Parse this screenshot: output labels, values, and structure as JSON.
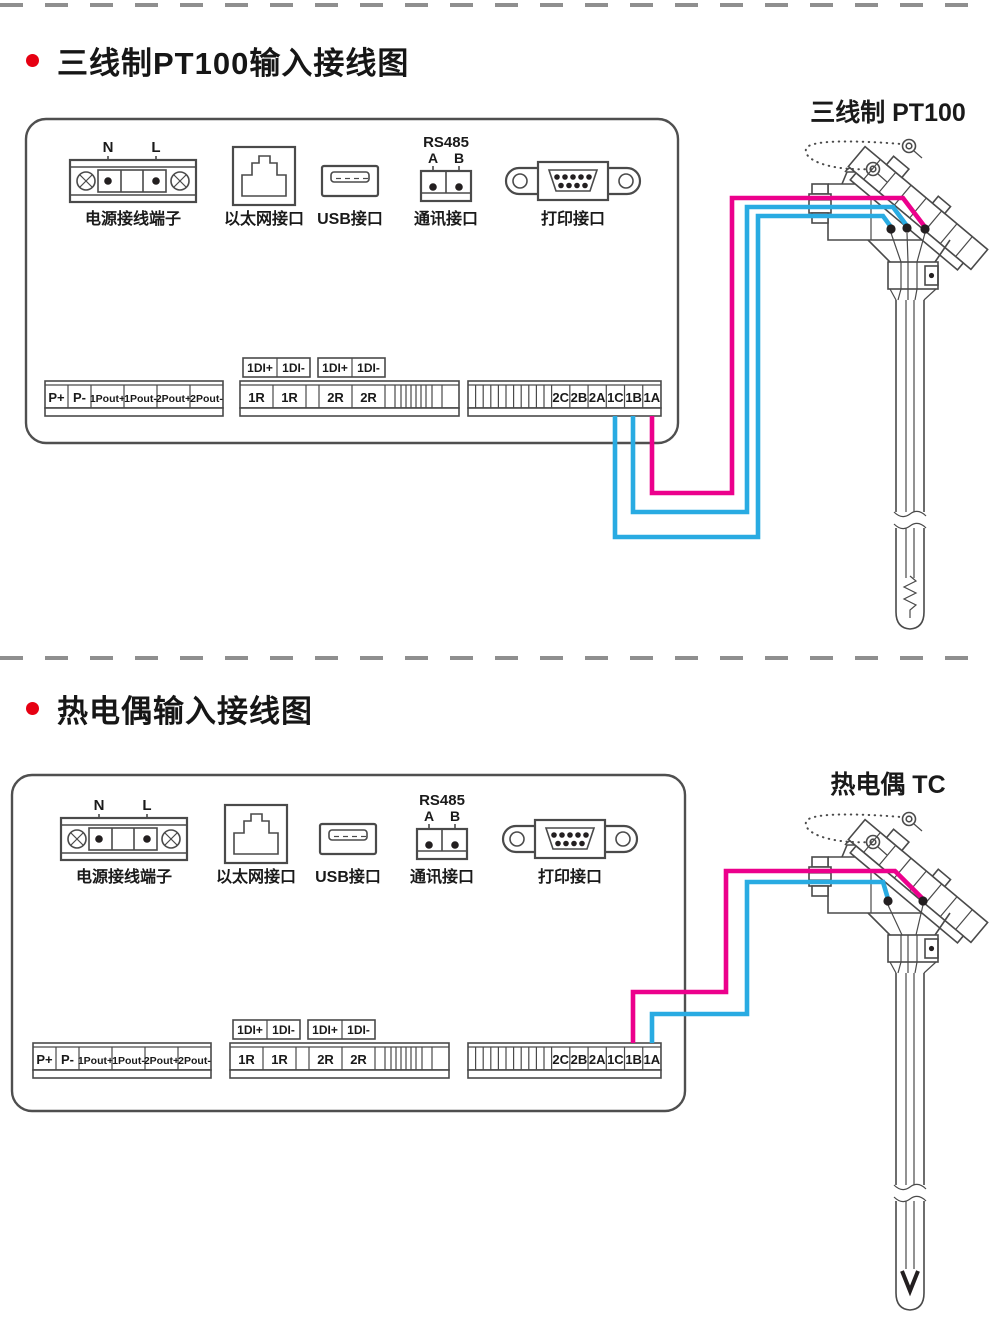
{
  "colors": {
    "wire_pink": "#ec008c",
    "wire_blue": "#29abe2",
    "outline": "#4a4a4a",
    "divider_gray": "#8f8f8f",
    "bullet_red": "#e60012",
    "text_dark": "#1a1a1a",
    "terminal_dot": "#231f20"
  },
  "sections": [
    {
      "title": "三线制PT100输入接线图",
      "sensor_title": "三线制 PT100",
      "sensor_type": "pt100",
      "ports": {
        "power": {
          "caption": "电源接线端子",
          "pin_left": "N",
          "pin_right": "L"
        },
        "ethernet": {
          "caption": "以太网接口"
        },
        "usb": {
          "caption": "USB接口"
        },
        "rs485": {
          "caption": "通讯接口",
          "heading": "RS485",
          "pin_a": "A",
          "pin_b": "B"
        },
        "printer": {
          "caption": "打印接口"
        }
      },
      "strips": {
        "power_out": [
          "P+",
          "P-",
          "1Pout+",
          "1Pout-",
          "2Pout+",
          "2Pout-"
        ],
        "di_boxes": [
          [
            "1DI+",
            "1DI-"
          ],
          [
            "1DI+",
            "1DI-"
          ]
        ],
        "relay": [
          "1R",
          "1R",
          "",
          "2R",
          "2R"
        ],
        "analog_in": [
          "2C",
          "2B",
          "2A",
          "1C",
          "1B",
          "1A"
        ]
      },
      "connections": [
        {
          "from": "1A",
          "color": "pink"
        },
        {
          "from": "1B",
          "color": "blue"
        },
        {
          "from": "1C",
          "color": "blue"
        }
      ]
    },
    {
      "title": "热电偶输入接线图",
      "sensor_title": "热电偶 TC",
      "sensor_type": "tc",
      "ports": {
        "power": {
          "caption": "电源接线端子",
          "pin_left": "N",
          "pin_right": "L"
        },
        "ethernet": {
          "caption": "以太网接口"
        },
        "usb": {
          "caption": "USB接口"
        },
        "rs485": {
          "caption": "通讯接口",
          "heading": "RS485",
          "pin_a": "A",
          "pin_b": "B"
        },
        "printer": {
          "caption": "打印接口"
        }
      },
      "strips": {
        "power_out": [
          "P+",
          "P-",
          "1Pout+",
          "1Pout-",
          "2Pout+",
          "2Pout-"
        ],
        "di_boxes": [
          [
            "1DI+",
            "1DI-"
          ],
          [
            "1DI+",
            "1DI-"
          ]
        ],
        "relay": [
          "1R",
          "1R",
          "",
          "2R",
          "2R"
        ],
        "analog_in": [
          "2C",
          "2B",
          "2A",
          "1C",
          "1B",
          "1A"
        ]
      },
      "connections": [
        {
          "from": "1B",
          "color": "pink"
        },
        {
          "from": "1A",
          "color": "blue"
        }
      ]
    }
  ]
}
